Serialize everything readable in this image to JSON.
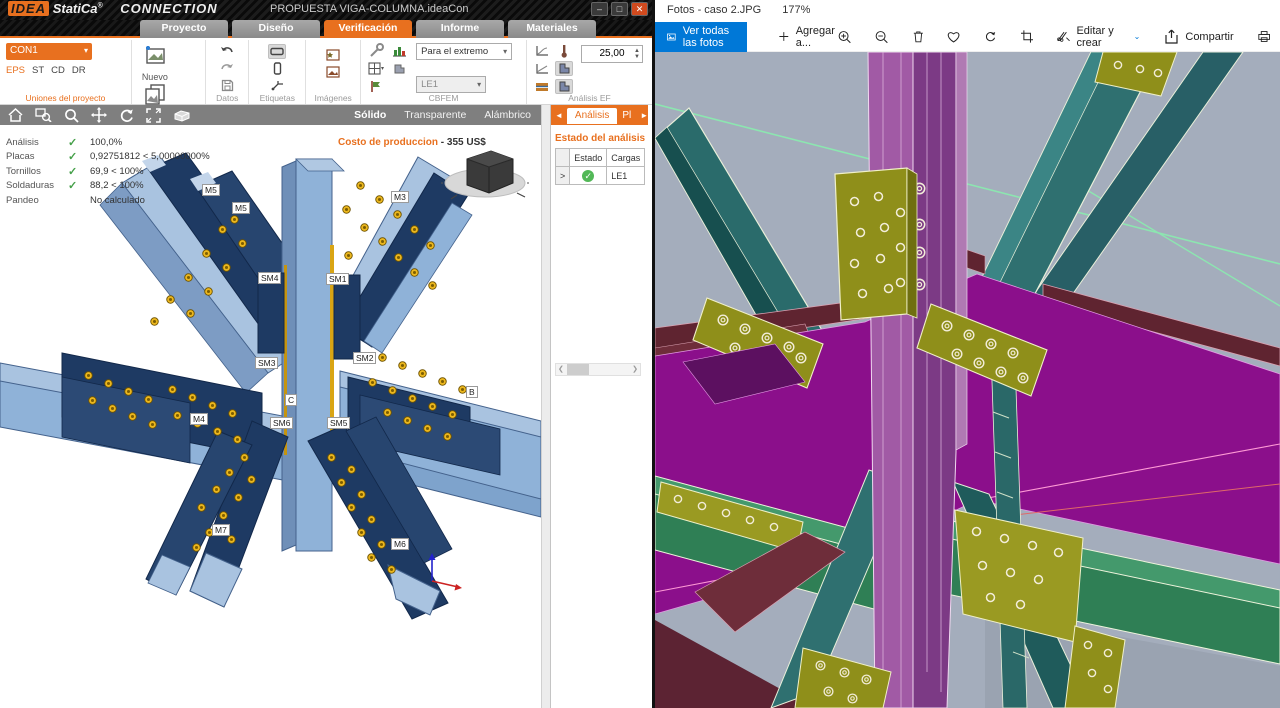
{
  "idea": {
    "titlebar": {
      "brand": "IDEA",
      "brand2": "StatiCa",
      "reg": "®",
      "product": "CONNECTION",
      "tagline": "Calculate yesterday's estimates",
      "doc_title": "PROPUESTA VIGA-COLUMNA.ideaCon",
      "minimize": "–",
      "maximize": "□",
      "close": "✕"
    },
    "tabs": [
      {
        "label": "Proyecto"
      },
      {
        "label": "Diseño"
      },
      {
        "label": "Verificación"
      },
      {
        "label": "Informe"
      },
      {
        "label": "Materiales"
      }
    ],
    "ribbon": {
      "connection_name": "CON1",
      "modes": [
        "EPS",
        "ST",
        "CD",
        "DR"
      ],
      "new_label": "Nuevo",
      "copy_label": "Copiar",
      "group_project": "Uniones del proyecto",
      "group_data": "Datos",
      "group_labels": "Etiquetas",
      "group_images": "Imágenes",
      "group_cbfem": "CBFEM",
      "group_fem": "Análisis EF",
      "extreme_dropdown": "Para el extremo",
      "le_dropdown": "LE1",
      "mesh_value": "25,00"
    },
    "viewbar": {
      "solid": "Sólido",
      "transparent": "Transparente",
      "wire": "Alámbrico"
    },
    "status": [
      {
        "label": "Análisis",
        "check": "✓",
        "value": "100,0%"
      },
      {
        "label": "Placas",
        "check": "✓",
        "value": "0,92751812 < 5,00000000%"
      },
      {
        "label": "Tornillos",
        "check": "✓",
        "value": "69,9 < 100%"
      },
      {
        "label": "Soldaduras",
        "check": "✓",
        "value": "88,2 < 100%"
      },
      {
        "label": "Pandeo",
        "check": "",
        "value": "No calculado"
      }
    ],
    "cost": {
      "label": "Costo de produccion",
      "value": "- 355 US$"
    },
    "model_labels": [
      "M5",
      "M5",
      "M3",
      "SM4",
      "SM1",
      "SM3",
      "SM2",
      "C",
      "B",
      "M4",
      "SM6",
      "SM5",
      "M7",
      "M6"
    ],
    "axes": {
      "x": "X",
      "z": "Z"
    },
    "panel": {
      "tab_prev": "◄",
      "tab_analysis": "Análisis",
      "tab_next_partial": "Pl",
      "tab_fwd": "►",
      "title": "Estado del análisis F",
      "col_estado": "Estado",
      "col_cargas": "Cargas",
      "row_selector": ">",
      "row_ok": "✓",
      "row_load": "LE1"
    }
  },
  "photos": {
    "title": "Fotos - caso 2.JPG",
    "zoom_level": "177%",
    "toolbar": {
      "see_all": "Ver todas las fotos",
      "add_to": "Agregar a...",
      "edit_create": "Editar y crear",
      "edit_chevron": "⌄",
      "share": "Compartir"
    }
  },
  "colors": {
    "idea_orange": "#e8701f",
    "photos_blue": "#0078d7",
    "check_green": "#45a049",
    "cad_background": "#a4adbc",
    "model_steel_light": "#93b4d9",
    "model_steel_dark": "#1e3a63",
    "bolt_gold": "#ecb71e",
    "cad_magenta": "#8b0f8b",
    "cad_teal": "#2f7070",
    "cad_olive": "#8f8f1a",
    "cad_maroon": "#5f2430"
  }
}
